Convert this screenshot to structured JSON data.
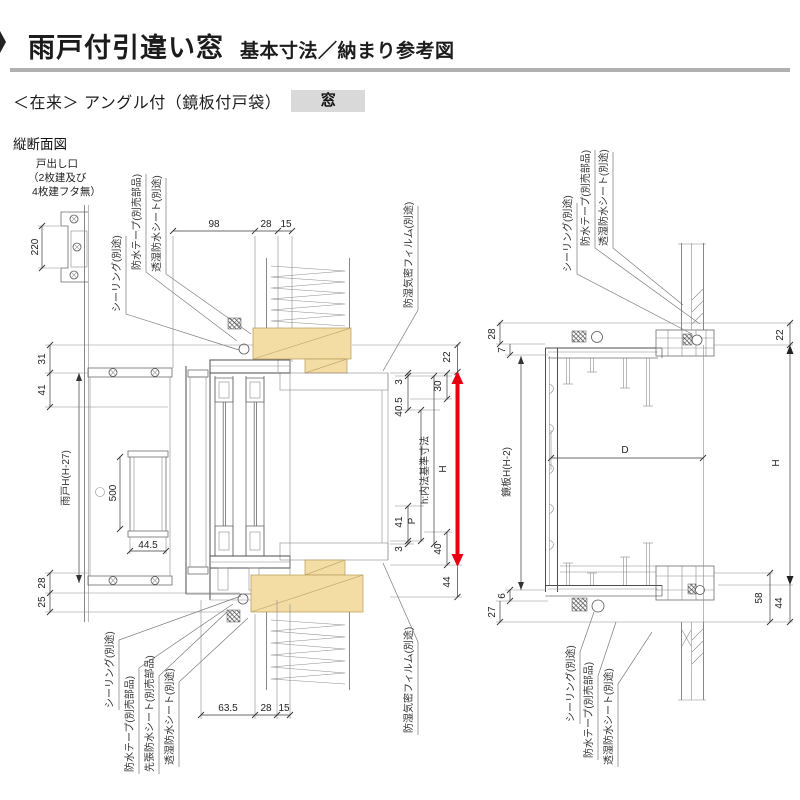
{
  "header": {
    "title": "雨戸付引違い窓",
    "title_suffix": "基本寸法／納まり参考図",
    "series_label": "＜在来＞ アングル付（鏡板付戸袋）",
    "badge": "窓",
    "section_label": "縦断面図"
  },
  "terms": {
    "sealing": "シーリング(別途)",
    "tape": "防水テープ(別売部品)",
    "sheet": "透湿防水シート(別途)",
    "pre_sheet": "先張防水シート(別売部品)",
    "film": "防湿気密フィルム(別途)"
  },
  "left": {
    "note": [
      "戸出し口",
      "（2枚建及び",
      "4枚建フタ無）"
    ],
    "labels": {
      "shutter_h": "雨戸H(H-27)",
      "inner_std": "h:内法基準寸法",
      "pitch": "P",
      "height": "H"
    },
    "dims": {
      "outlet": "220",
      "top": [
        "98",
        "28",
        "15"
      ],
      "left_top": [
        "31",
        "41"
      ],
      "left_bottom": [
        "28",
        "25"
      ],
      "opening": "500",
      "opening_w": "44.5",
      "right": {
        "d22": "22",
        "d30": "30",
        "d3t": "3",
        "d405": "40.5",
        "d41": "41",
        "d3b": "3",
        "d40": "40",
        "d44": "44"
      },
      "bottom": [
        "63.5",
        "28",
        "15"
      ]
    }
  },
  "right": {
    "labels": {
      "board_h": "鏡板H(H-2)",
      "depth": "D",
      "height": "H"
    },
    "dims": {
      "d28": "28",
      "d7": "7",
      "d22": "22",
      "d6": "6",
      "d27": "27",
      "d58": "58",
      "d44": "44"
    }
  },
  "colors": {
    "accent_red": "#e60012",
    "wood_fill": "#f3dda4",
    "badge_bg": "#d9d9d9",
    "rule_gray": "#b0b0b0"
  }
}
